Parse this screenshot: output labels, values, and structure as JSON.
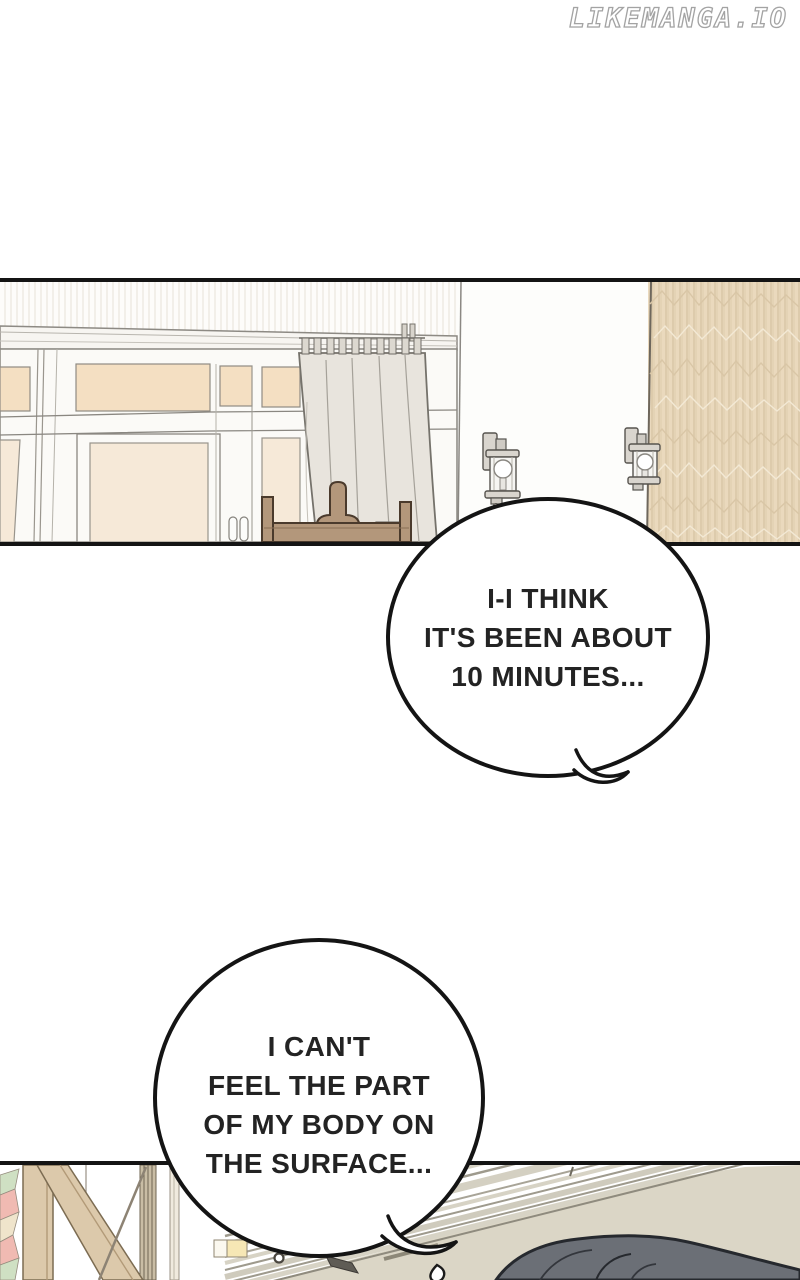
{
  "watermark": {
    "text": "LIKEMANGA.IO"
  },
  "speech_bubbles": [
    {
      "name": "bubble-1",
      "lines": [
        "I-I THINK",
        "IT'S BEEN ABOUT",
        "10 MINUTES..."
      ]
    },
    {
      "name": "bubble-2",
      "lines": [
        "I CAN'T",
        "FEEL THE PART",
        "OF MY BODY ON",
        "THE SURFACE..."
      ]
    }
  ],
  "palette": {
    "ink": "#232323",
    "line": "#141414",
    "bubble_fill": "#ffffff",
    "watermark_outline": "#a3a3a3",
    "pane": "#f4dfc2",
    "pane_light": "#f6e9d8",
    "frame_white": "#fbfaf7",
    "curtain": "#e8e4dd",
    "chair_wood": "#b3977b",
    "beam_wood": "#dcc9ab",
    "floor": "#dbd6c6",
    "figure_dark": "#6b6f76",
    "lamp_metal": "#d9d5ce",
    "mosaic_pink": "#f0bab2",
    "mosaic_green": "#cfe0c3",
    "mosaic_cream": "#efe4cb"
  }
}
